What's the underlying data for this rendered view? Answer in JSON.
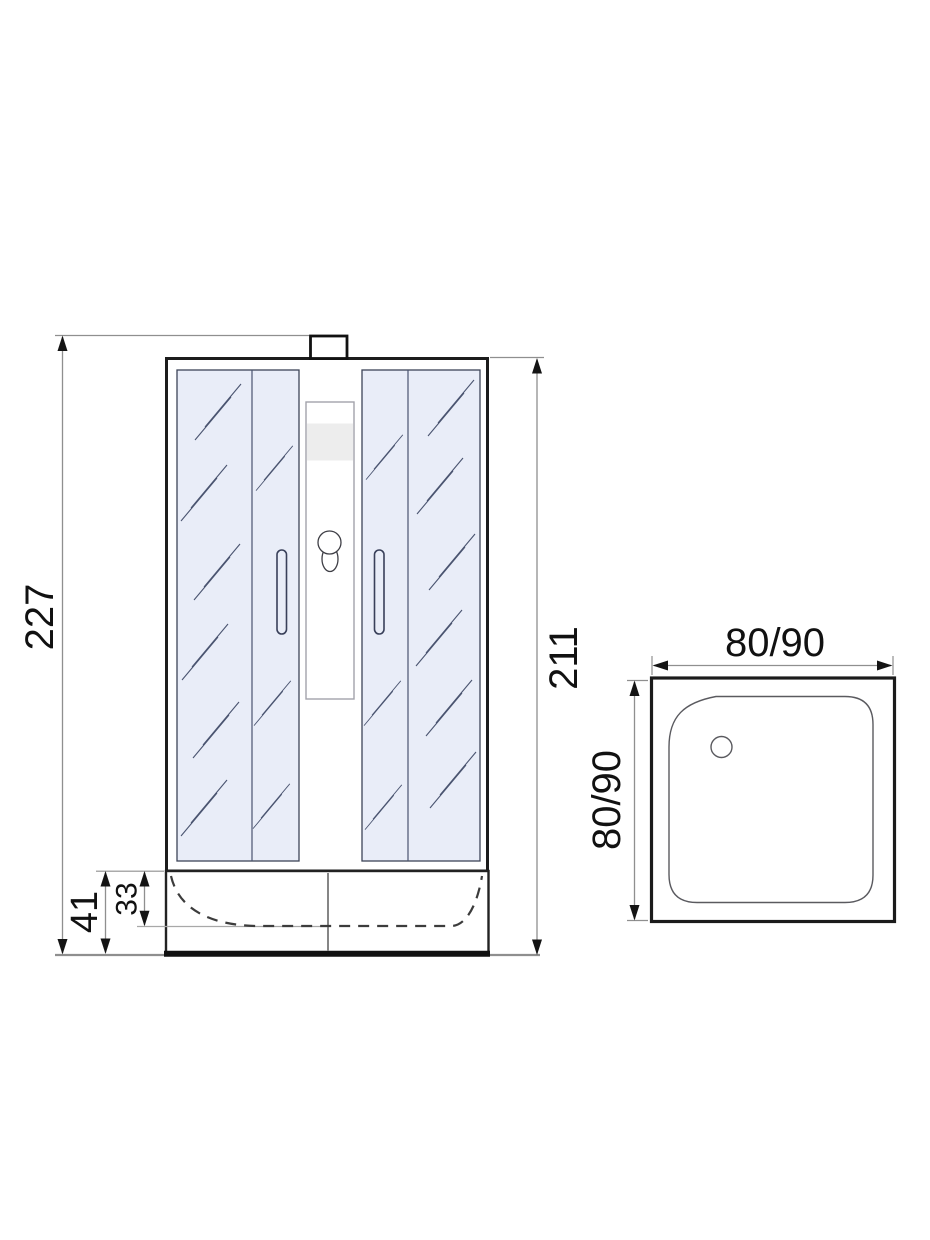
{
  "views": {
    "front": {
      "dim_total_height": "227",
      "dim_cabin_height": "211",
      "dim_tray_height": "41",
      "dim_tray_inner_depth": "33"
    },
    "top": {
      "dim_width": "80/90",
      "dim_depth": "80/90"
    }
  },
  "colors": {
    "glass": "#e9edf8",
    "frame": "#1b1b1b",
    "dimension_line": "#8f8f8f",
    "label_text": "#111111",
    "shelf_band": "#ededed"
  }
}
